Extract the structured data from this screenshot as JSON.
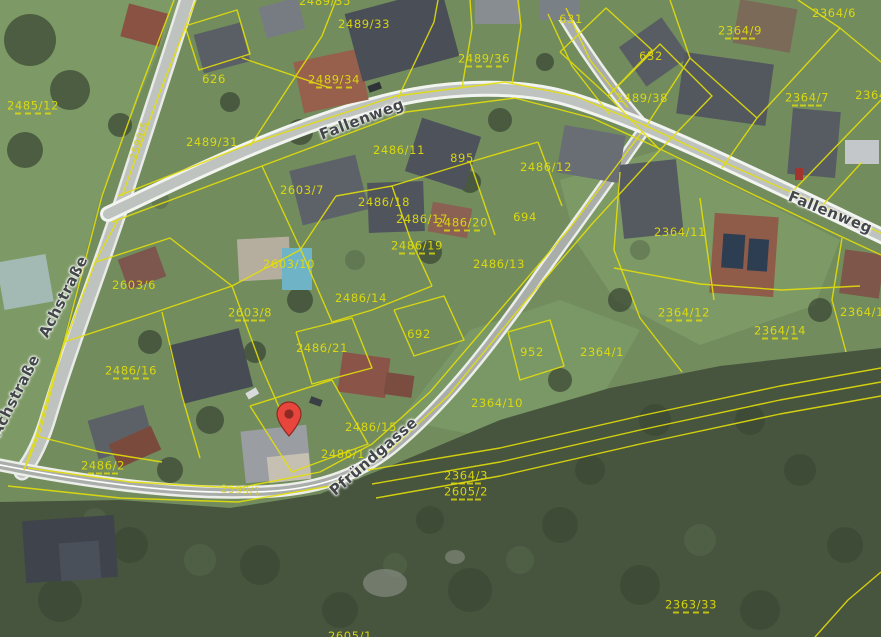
{
  "map": {
    "description": "aerial cadastral map view",
    "marker": {
      "x": 289,
      "y": 437,
      "color": "#e8453c",
      "inner_color": "#8c2b24"
    },
    "street_labels": [
      {
        "text": "Fallenweg",
        "x": 362,
        "y": 120,
        "rot": -21
      },
      {
        "text": "Fallenweg",
        "x": 830,
        "y": 213,
        "rot": 22
      },
      {
        "text": "Achstraße",
        "x": 64,
        "y": 297,
        "rot": -63
      },
      {
        "text": "Achstraße",
        "x": 16,
        "y": 396,
        "rot": -63
      },
      {
        "text": "Pfründgasse",
        "x": 374,
        "y": 457,
        "rot": -41
      }
    ],
    "road_labels": [
      {
        "text": "2599/5",
        "x": 140,
        "y": 141,
        "rot": -72
      },
      {
        "text": "2599/1",
        "x": 241,
        "y": 491,
        "rot": 4
      }
    ],
    "parcel_labels": [
      {
        "text": "2485/12",
        "x": 33,
        "y": 107,
        "dash": true
      },
      {
        "text": "626",
        "x": 214,
        "y": 79
      },
      {
        "text": "2489/35",
        "x": 325,
        "y": 1
      },
      {
        "text": "2489/33",
        "x": 364,
        "y": 24
      },
      {
        "text": "2489/31",
        "x": 212,
        "y": 142
      },
      {
        "text": "2489/34",
        "x": 334,
        "y": 81,
        "dash": true
      },
      {
        "text": "2489/36",
        "x": 484,
        "y": 60,
        "dash": true
      },
      {
        "text": "631",
        "x": 571,
        "y": 19
      },
      {
        "text": "632",
        "x": 651,
        "y": 56
      },
      {
        "text": "2489/38",
        "x": 642,
        "y": 98
      },
      {
        "text": "2364/9",
        "x": 740,
        "y": 32,
        "dash": true
      },
      {
        "text": "2364/6",
        "x": 834,
        "y": 13
      },
      {
        "text": "2364/7",
        "x": 807,
        "y": 99,
        "dash": true
      },
      {
        "text": "2364",
        "x": 871,
        "y": 95
      },
      {
        "text": "2486/11",
        "x": 399,
        "y": 150
      },
      {
        "text": "895",
        "x": 462,
        "y": 158
      },
      {
        "text": "2486/12",
        "x": 546,
        "y": 167
      },
      {
        "text": "2603/7",
        "x": 302,
        "y": 190
      },
      {
        "text": "2486/18",
        "x": 384,
        "y": 202
      },
      {
        "text": "2486/17",
        "x": 422,
        "y": 219
      },
      {
        "text": "2486/20",
        "x": 462,
        "y": 224,
        "dash": true
      },
      {
        "text": "694",
        "x": 525,
        "y": 217
      },
      {
        "text": "2486/19",
        "x": 417,
        "y": 247,
        "dash": true
      },
      {
        "text": "2486/13",
        "x": 499,
        "y": 264
      },
      {
        "text": "2603/10",
        "x": 289,
        "y": 264
      },
      {
        "text": "2603/6",
        "x": 134,
        "y": 285
      },
      {
        "text": "2364/11",
        "x": 680,
        "y": 232
      },
      {
        "text": "2486/14",
        "x": 361,
        "y": 298
      },
      {
        "text": "2603/8",
        "x": 250,
        "y": 314,
        "dash": true
      },
      {
        "text": "2486/21",
        "x": 322,
        "y": 348
      },
      {
        "text": "692",
        "x": 419,
        "y": 334
      },
      {
        "text": "952",
        "x": 532,
        "y": 352
      },
      {
        "text": "2364/1",
        "x": 602,
        "y": 352
      },
      {
        "text": "2364/12",
        "x": 684,
        "y": 314,
        "dash": true
      },
      {
        "text": "2364/14",
        "x": 780,
        "y": 332,
        "dash": true
      },
      {
        "text": "2364/13",
        "x": 866,
        "y": 312
      },
      {
        "text": "2486/16",
        "x": 131,
        "y": 372,
        "dash": true
      },
      {
        "text": "2364/10",
        "x": 497,
        "y": 403
      },
      {
        "text": "2486/15",
        "x": 371,
        "y": 427
      },
      {
        "text": "2486/1",
        "x": 343,
        "y": 454
      },
      {
        "text": "2486/2",
        "x": 103,
        "y": 467,
        "dash": true
      },
      {
        "text": "2364/3",
        "x": 466,
        "y": 477,
        "dash": true
      },
      {
        "text": "2605/2",
        "x": 466,
        "y": 493,
        "dash": true
      },
      {
        "text": "2363/33",
        "x": 691,
        "y": 606,
        "dash": true
      },
      {
        "text": "2605/1",
        "x": 350,
        "y": 636
      }
    ],
    "colors": {
      "parcel_line": "#e3de0a",
      "street_text": "#43474a",
      "grass": "#728c5e",
      "forest": "#47543e",
      "road": "#bfc3bf"
    }
  }
}
